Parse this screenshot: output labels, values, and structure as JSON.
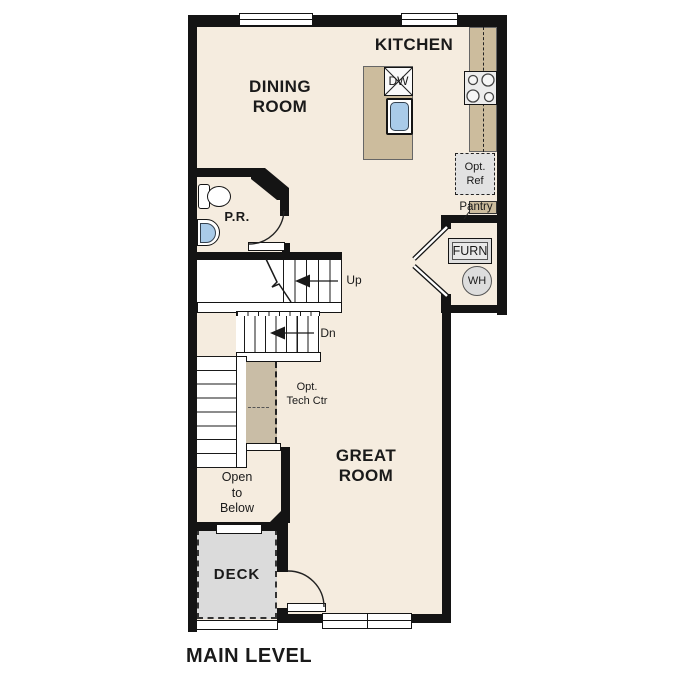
{
  "plan": {
    "title": "MAIN LEVEL",
    "rooms": {
      "kitchen": "KITCHEN",
      "dining": {
        "line1": "DINING",
        "line2": "ROOM"
      },
      "great": {
        "line1": "GREAT",
        "line2": "ROOM"
      },
      "powder_room": "P.R.",
      "deck": "DECK"
    },
    "stairs": {
      "up": "Up",
      "down": "Dn"
    },
    "fixtures": {
      "dishwasher": "DW",
      "furnace": "FURN",
      "water_heater": "WH",
      "pantry": "Pantry",
      "opt_ref": {
        "line1": "Opt.",
        "line2": "Ref"
      },
      "tech_center": {
        "line1": "Opt.",
        "line2": "Tech Ctr"
      },
      "open_to_below": {
        "line1": "Open",
        "line2": "to",
        "line3": "Below"
      }
    },
    "colors": {
      "floor": "#f5ecdf",
      "counter": "#ccbc9d",
      "cabinet": "#c9bda6",
      "deck": "#dbdbdb",
      "sink_blue": "#a9cbe9",
      "wall": "#141414",
      "appliance_gray": "#e2e2e2"
    }
  }
}
